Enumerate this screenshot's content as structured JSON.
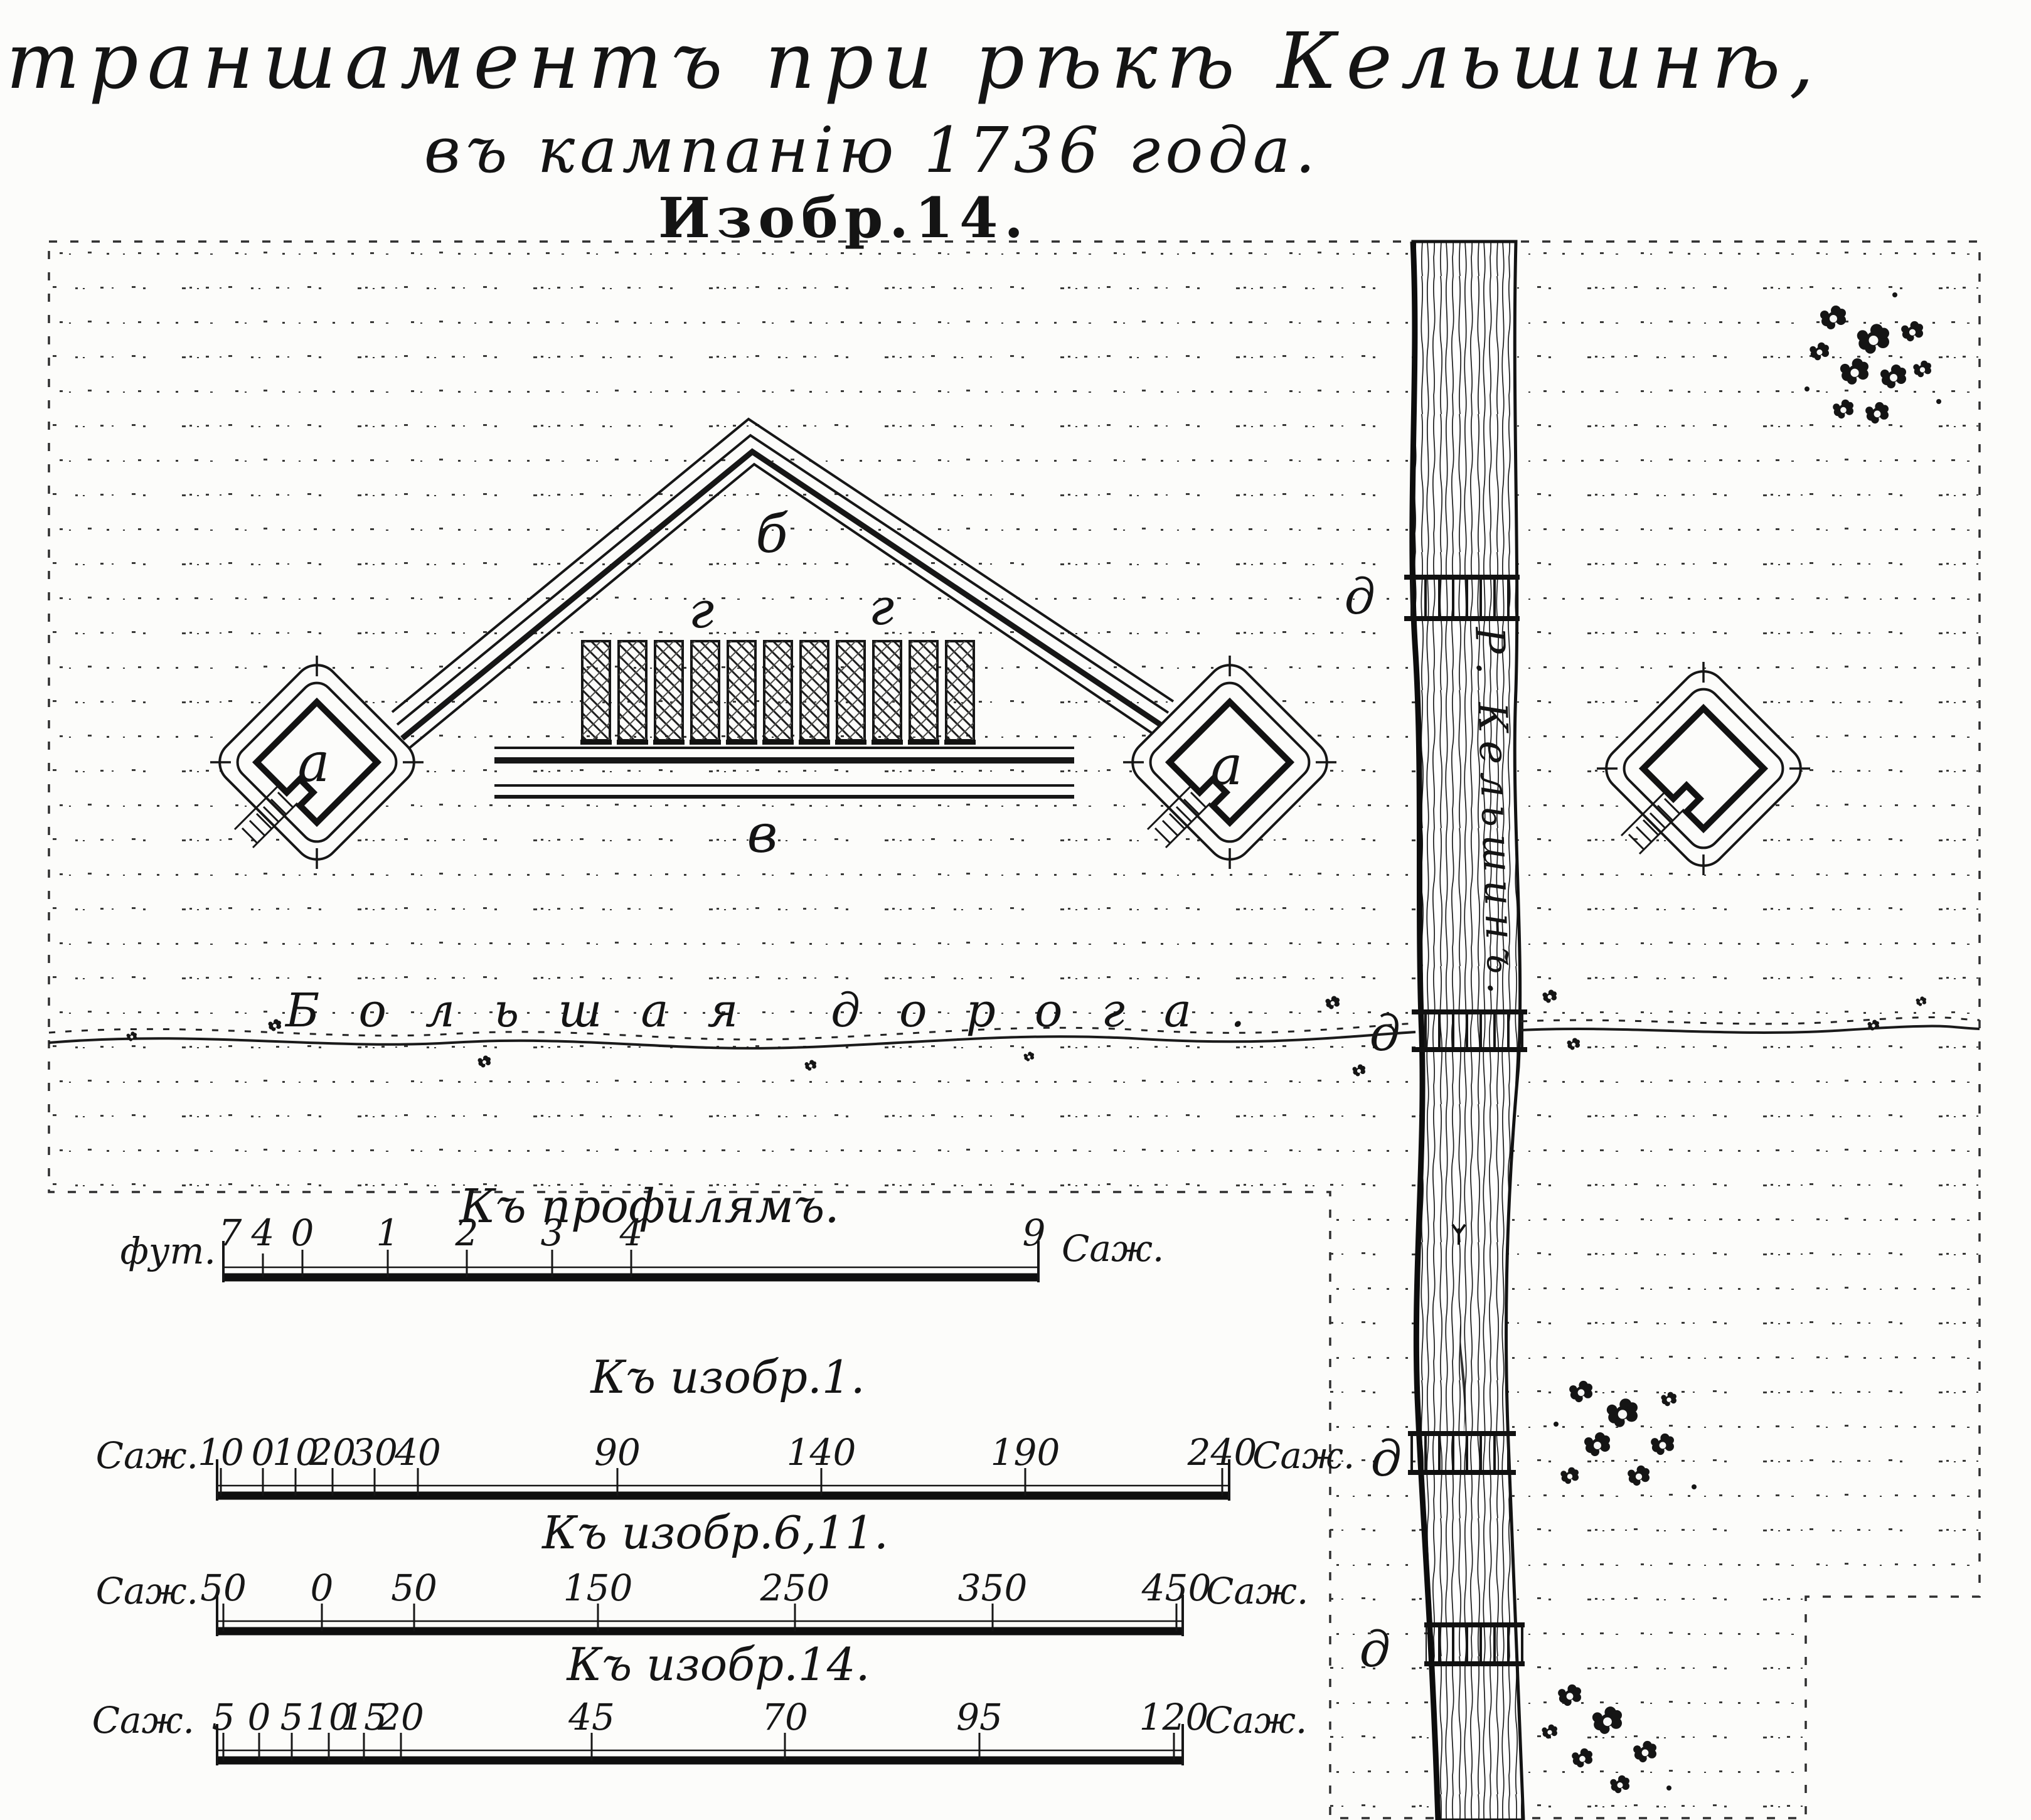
{
  "title": {
    "line1": "Ретраншаментъ при рѣкѣ Кельшинѣ,",
    "line2": "въ кампанію 1736 года.",
    "line3": "Изобр.14."
  },
  "plan": {
    "redoubt_label_left": "а",
    "redoubt_label_middle": "а",
    "curtain_label": "б",
    "line_label": "в",
    "barracks_label_1": "г",
    "barracks_label_2": "г",
    "barracks_count": 11,
    "bridge_labels": [
      "д",
      "д",
      "д",
      "д"
    ],
    "river_label": "Р. Кельшинъ.",
    "road_label": "Большая дорога."
  },
  "scales": [
    {
      "heading": "Къ профилямъ.",
      "unit_left": "фут.",
      "ticks": [
        "7",
        "4",
        "0",
        "1",
        "2",
        "3",
        "4",
        "9"
      ],
      "unit_right": "Саж."
    },
    {
      "heading": "Къ изобр.1.",
      "unit_left": "Саж.",
      "ticks": [
        "10",
        "0",
        "10",
        "20",
        "30",
        "40",
        "90",
        "140",
        "190",
        "240"
      ],
      "unit_right": "Саж."
    },
    {
      "heading": "Къ изобр.6,11.",
      "unit_left": "Саж.",
      "ticks": [
        "50",
        "0",
        "50",
        "150",
        "250",
        "350",
        "450"
      ],
      "unit_right": "Саж."
    },
    {
      "heading": "Къ изобр.14.",
      "unit_left": "Саж.",
      "ticks": [
        "5",
        "0",
        "5",
        "10",
        "15",
        "20",
        "45",
        "70",
        "95",
        "120"
      ],
      "unit_right": "Саж."
    }
  ],
  "colors": {
    "ink": "#161616",
    "paper": "#fcfcfa"
  }
}
